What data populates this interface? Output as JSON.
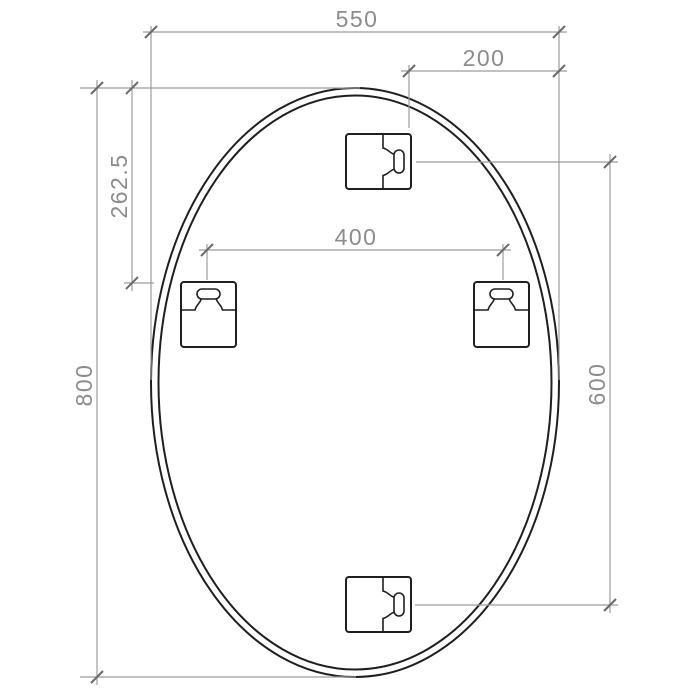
{
  "drawing": {
    "dimension_labels": {
      "overall_width": "550",
      "overall_height": "800",
      "top_bracket_from_right_edge": "200",
      "side_brackets_from_top": "262.5",
      "side_bracket_spacing": "400",
      "top_to_bottom_bracket_spacing": "600"
    },
    "colors": {
      "background": "#ffffff",
      "outline": "#1f1f1f",
      "dimension_line": "#9c9c9c",
      "dimension_text": "#8c8c8c",
      "tick": "#6a6a6a"
    }
  }
}
